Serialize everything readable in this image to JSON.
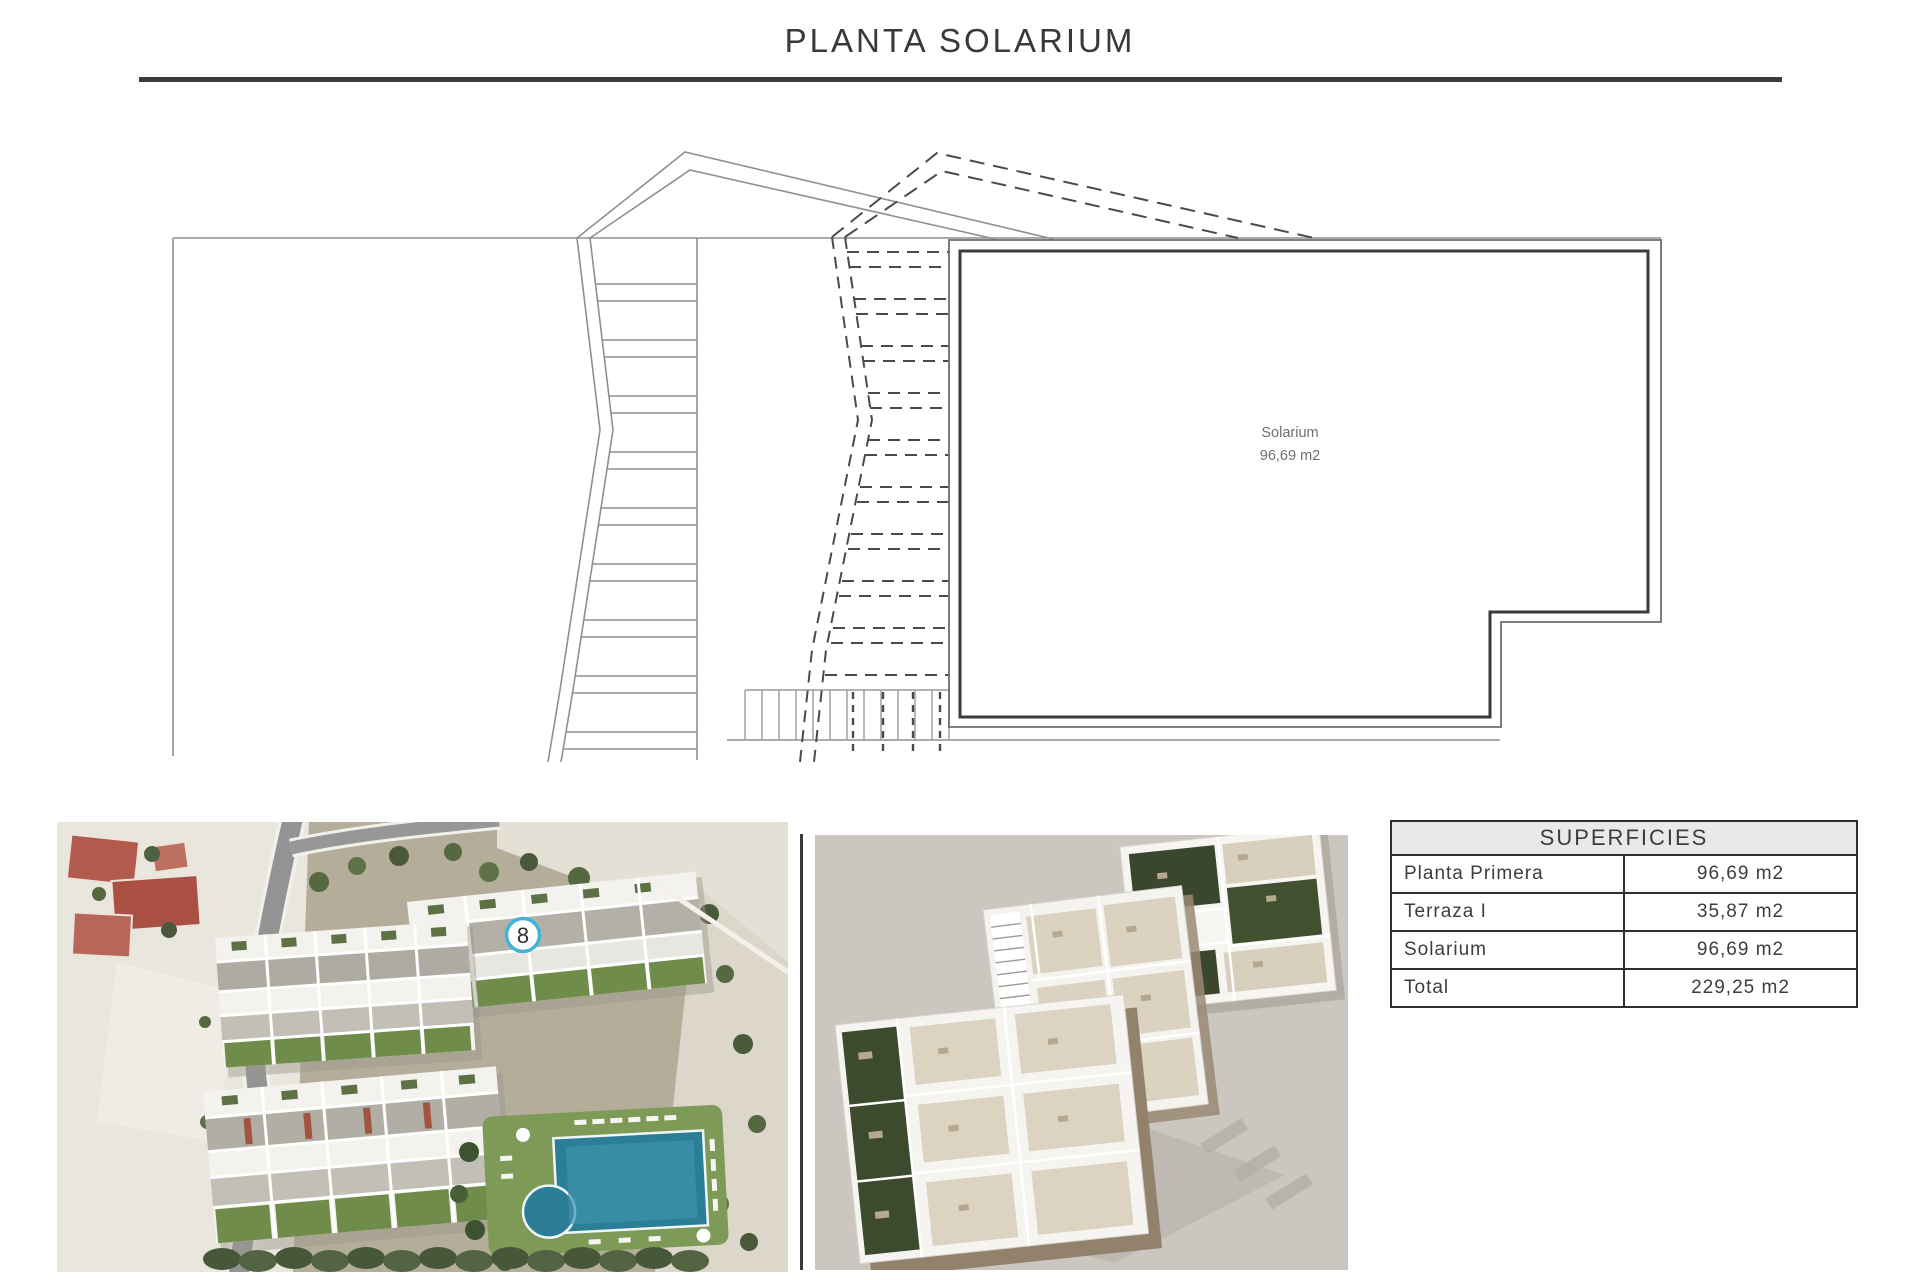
{
  "title": "PLANTA SOLARIUM",
  "plan": {
    "room_label": "Solarium",
    "room_area": "96,69 m2"
  },
  "aerial_photo": {
    "unit_badge": "8",
    "badge_ring_color": "#3fb4d8"
  },
  "superficies_table": {
    "header": "SUPERFICIES",
    "rows": [
      {
        "label": "Planta Primera",
        "value": "96,69 m2"
      },
      {
        "label": "Terraza I",
        "value": "35,87 m2"
      },
      {
        "label": "Solarium",
        "value": "96,69 m2"
      },
      {
        "label": "Total",
        "value": "229,25 m2"
      }
    ]
  },
  "colors": {
    "accent_dark": "#3a3a3a",
    "line_grey": "#8f8f8f",
    "dashed_line": "#4a4a4a",
    "table_header_bg": "#e9e9e9",
    "pool": "#2c7e97",
    "badge_ring": "#3fb4d8"
  }
}
